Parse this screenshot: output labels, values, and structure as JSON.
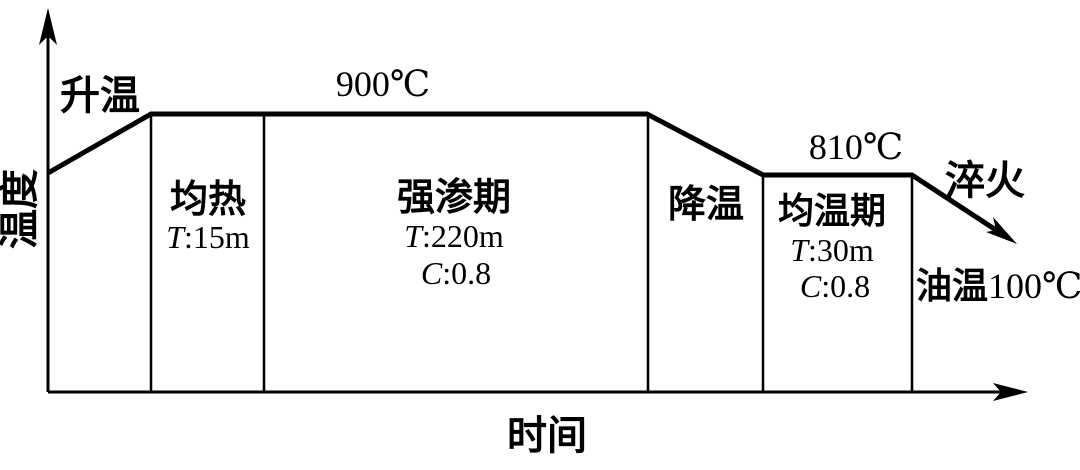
{
  "figure": {
    "y_axis_label": "温度",
    "x_axis_label": "时间",
    "heating_label": "升温",
    "peak_temperature": "900℃",
    "second_temperature": "810℃",
    "quench_label": "淬火",
    "oil_label": "油温",
    "oil_value": "100℃",
    "stages": [
      {
        "name": "均热",
        "p1_sym": "T",
        "p1_val": ":15m"
      },
      {
        "name": "强渗期",
        "p1_sym": "T",
        "p1_val": ":220m",
        "p2_sym": "C",
        "p2_val": ":0.8"
      },
      {
        "name": "降温"
      },
      {
        "name": "均温期",
        "p1_sym": "T",
        "p1_val": ":30m",
        "p2_sym": "C",
        "p2_val": ":0.8"
      }
    ],
    "colors": {
      "line": "#000000",
      "background": "#ffffff"
    }
  }
}
